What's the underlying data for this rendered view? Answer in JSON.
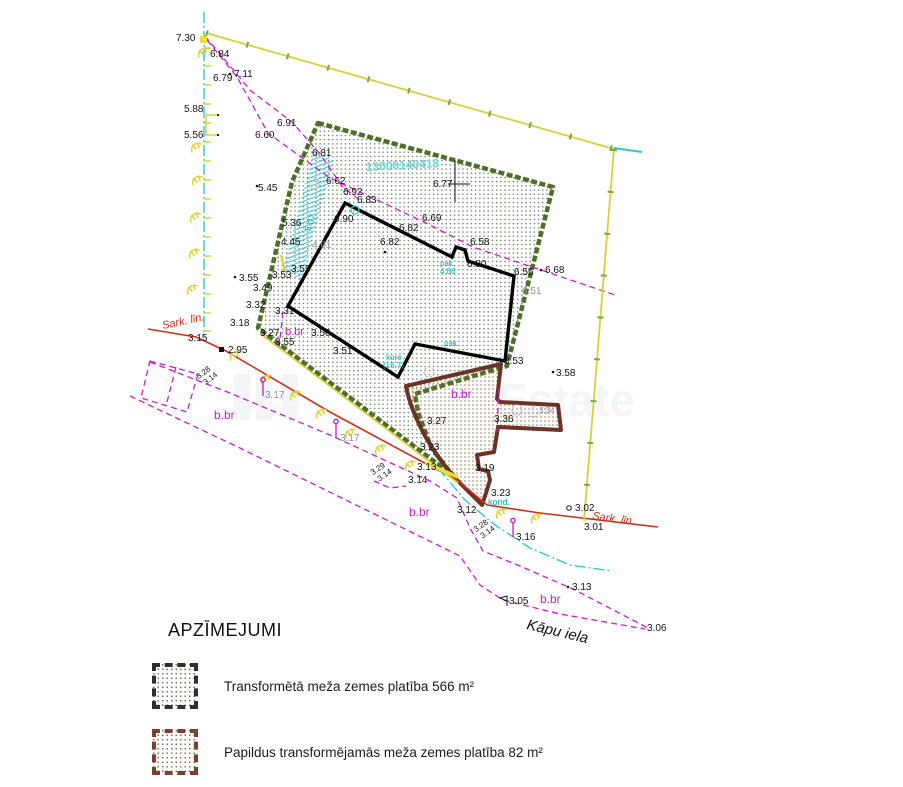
{
  "watermark": {
    "text": "Estate",
    "bars": [
      [
        234,
        374
      ],
      [
        256,
        374
      ],
      [
        282,
        374
      ]
    ],
    "text_x": 497,
    "text_y": 416
  },
  "legend": {
    "title": "APZĪMEJUMI",
    "items": [
      {
        "label": "Transformētā meža zemes platība 566 m²",
        "border": "#2f2f2f",
        "dot": "#6b7a5e"
      },
      {
        "label": "Papildus transformējamās meža zemes platība 82 m²",
        "border": "#7a4030",
        "dot": "#8a6f57"
      }
    ]
  },
  "colors": {
    "black": "#141414",
    "gray": "#8f8f8f",
    "magenta": "#c81dc8",
    "cyan": "#00b2b2",
    "cadastral": "#66d6d6",
    "red": "#d32a1a",
    "green_border": "#4f6e2a",
    "brown": "#6b3226",
    "yellow": "#d8d03a"
  },
  "plan": {
    "cadastral_number": "13000140418",
    "street": "Kāpu iela",
    "red_line_label": "Sark. līn.",
    "polygons": {
      "green": "318,123 553,187 507,366 480,374 415,394 418,412 431,447 446,467 456,478 258,328 292,182",
      "brown": "M406,386 L501,364 L497,399 L500,402 L558,405 L561,430 L498,427 L494,452 L477,455 L479,469 L488,471 L490,480 L486,493 L482,505 L456,479 Q432,452 419,424 Q409,403 406,386 Z",
      "building": "345,203 452,257 456,247 465,250 468,261 514,276 505,361 415,344 398,377 288,306",
      "hatch": "314,150 334,160 301,281 283,270",
      "roadRect": "150,361 198,374 187,412 141,398"
    },
    "polylines": [
      {
        "k": "md",
        "n": "plot-boundary-dashed-1",
        "p": "205,36 250,90 292,122 320,154 342,186 362,202"
      },
      {
        "k": "md",
        "n": "plot-boundary-dashed-2",
        "p": "207,40 237,77 268,133 330,178 424,222 473,247 618,296"
      },
      {
        "k": "md",
        "n": "road-band-upper",
        "p": "150,362 230,393 330,435 430,481 457,498 470,528 483,551 520,566 573,589 648,628"
      },
      {
        "k": "md",
        "n": "road-band-lower",
        "p": "130,396 240,448 350,502 460,556 480,585 503,600 560,614 645,629"
      },
      {
        "k": "md",
        "n": "dashed-tick-right",
        "p": "499,388 497,432"
      },
      {
        "k": "md",
        "n": "dashed-tick-left",
        "p": "283,312 279,348"
      },
      {
        "k": "md",
        "n": "dashed-curve-314",
        "p": "374,481 390,488 406,486"
      },
      {
        "k": "md",
        "n": "road-rect-divider",
        "p": "176,367 166,406"
      },
      {
        "k": "red",
        "n": "red-line",
        "p": "148,329 196,337 226,351 330,412 432,467 456,479 487,505 540,513 658,527"
      },
      {
        "k": "yel",
        "n": "fence-top",
        "p": "206,33 614,149"
      },
      {
        "k": "gtick",
        "n": "fence-top-ticks",
        "p": "206,33 614,149"
      },
      {
        "k": "yel",
        "n": "fence-right",
        "p": "614,149 584,521"
      },
      {
        "k": "gtick",
        "n": "fence-right-ticks",
        "p": "614,149 584,521"
      },
      {
        "k": "yel",
        "n": "fence-road",
        "p": "261,334 458,483"
      },
      {
        "k": "cdd",
        "n": "utility-line-left",
        "p": "204,12 204,336"
      },
      {
        "k": "cdd",
        "n": "utility-line-bottom",
        "p": "438,468 465,500 495,525 530,548 570,565 612,571"
      },
      {
        "k": "csolid",
        "n": "corner-tick",
        "p": "614,148 642,152"
      },
      {
        "k": "yel2",
        "n": "yellow-segment",
        "p": "281,255 285,272"
      },
      {
        "k": "yhl",
        "n": "yellow-highlight",
        "p": "425,463 458,477"
      }
    ],
    "labels": [
      {
        "t": "7.30",
        "x": 176,
        "y": 41
      },
      {
        "t": "6.84",
        "x": 210,
        "y": 57
      },
      {
        "t": "7.11",
        "x": 234,
        "y": 77
      },
      {
        "t": "6.79",
        "x": 213,
        "y": 81
      },
      {
        "t": "5.88",
        "x": 184,
        "y": 112
      },
      {
        "t": "5.56",
        "x": 184,
        "y": 138
      },
      {
        "t": "6.91",
        "x": 277,
        "y": 126
      },
      {
        "t": "6.60",
        "x": 255,
        "y": 138
      },
      {
        "t": "6.81",
        "x": 312,
        "y": 156
      },
      {
        "t": "6.62",
        "x": 326,
        "y": 184
      },
      {
        "t": "6.92",
        "x": 343,
        "y": 195
      },
      {
        "t": "6.83",
        "x": 357,
        "y": 203
      },
      {
        "t": "5.45",
        "x": 258,
        "y": 191
      },
      {
        "t": "6.77",
        "x": 433,
        "y": 187
      },
      {
        "t": "6.90",
        "x": 334,
        "y": 222
      },
      {
        "t": "6.69",
        "x": 422,
        "y": 221
      },
      {
        "t": "6.82",
        "x": 399,
        "y": 231
      },
      {
        "t": "6.82",
        "x": 380,
        "y": 245
      },
      {
        "t": "6.58",
        "x": 470,
        "y": 245
      },
      {
        "t": "5.36",
        "x": 282,
        "y": 226
      },
      {
        "t": "4.45",
        "x": 281,
        "y": 245
      },
      {
        "t": "4.61",
        "x": 312,
        "y": 248,
        "c": "g"
      },
      {
        "t": "6.80",
        "x": 467,
        "y": 267
      },
      {
        "t": "6.55",
        "x": 514,
        "y": 275
      },
      {
        "t": "6.68",
        "x": 545,
        "y": 273
      },
      {
        "t": "6.51",
        "x": 522,
        "y": 294,
        "c": "g"
      },
      {
        "t": "5.07",
        "x": 310,
        "y": 232,
        "c": "c",
        "s": 9,
        "r": -70
      },
      {
        "t": "3.55",
        "x": 291,
        "y": 272
      },
      {
        "t": "3.53",
        "x": 272,
        "y": 278
      },
      {
        "t": "3.49",
        "x": 253,
        "y": 291
      },
      {
        "t": "3.32",
        "x": 246,
        "y": 308
      },
      {
        "t": "3.31",
        "x": 275,
        "y": 314
      },
      {
        "t": "3.55",
        "x": 239,
        "y": 281
      },
      {
        "t": "3.27",
        "x": 260,
        "y": 336
      },
      {
        "t": "b.br",
        "x": 285,
        "y": 335,
        "c": "m",
        "s": 11
      },
      {
        "t": "3.55",
        "x": 275,
        "y": 345
      },
      {
        "t": "3.56",
        "x": 311,
        "y": 336
      },
      {
        "t": "3.51",
        "x": 333,
        "y": 354
      },
      {
        "t": "3.18",
        "x": 230,
        "y": 326
      },
      {
        "t": "3.15",
        "x": 188,
        "y": 341
      },
      {
        "t": "2.95",
        "x": 228,
        "y": 353
      },
      {
        "t": "Sark. līn.",
        "x": 163,
        "y": 329,
        "c": "r",
        "s": 11,
        "r": -12,
        "fs": "italic"
      },
      {
        "t": "3.17",
        "x": 265,
        "y": 398,
        "c": "g"
      },
      {
        "t": "3.17",
        "x": 340,
        "y": 441,
        "c": "g"
      },
      {
        "t": "b.br",
        "x": 214,
        "y": 419,
        "c": "m",
        "s": 12
      },
      {
        "t": "kore",
        "x": 386,
        "y": 360,
        "c": "c",
        "s": 8
      },
      {
        "t": "(16.7)",
        "x": 383,
        "y": 368,
        "c": "c",
        "s": 8
      },
      {
        "t": "pak.",
        "x": 440,
        "y": 266,
        "c": "c",
        "s": 8
      },
      {
        "t": "4.86",
        "x": 440,
        "y": 274,
        "c": "c",
        "s": 8
      },
      {
        "t": "pak.",
        "x": 444,
        "y": 346,
        "c": "c",
        "s": 8
      },
      {
        "t": "3.27",
        "x": 427,
        "y": 424
      },
      {
        "t": "3.23",
        "x": 420,
        "y": 450
      },
      {
        "t": "3.13",
        "x": 417,
        "y": 470
      },
      {
        "t": "3.14",
        "x": 408,
        "y": 483
      },
      {
        "t": "3.19",
        "x": 475,
        "y": 471
      },
      {
        "t": "3.36",
        "x": 494,
        "y": 422
      },
      {
        "t": "3.53",
        "x": 504,
        "y": 364
      },
      {
        "t": "3.58",
        "x": 556,
        "y": 376
      },
      {
        "t": "3.34",
        "x": 539,
        "y": 413,
        "c": "g",
        "s": 8
      },
      {
        "t": "b.br",
        "x": 451,
        "y": 398,
        "c": "m",
        "s": 12
      },
      {
        "t": "3.23",
        "x": 491,
        "y": 496
      },
      {
        "t": "kond.",
        "x": 488,
        "y": 505,
        "c": "c",
        "s": 9
      },
      {
        "t": "3.12",
        "x": 457,
        "y": 513
      },
      {
        "t": "b.br",
        "x": 409,
        "y": 516,
        "c": "m",
        "s": 12
      },
      {
        "t": "3.16",
        "x": 516,
        "y": 540
      },
      {
        "t": "3.02",
        "x": 575,
        "y": 511
      },
      {
        "t": "3.01",
        "x": 584,
        "y": 530
      },
      {
        "t": "Sark. līn.",
        "x": 592,
        "y": 519,
        "c": "r",
        "s": 11,
        "r": 8,
        "fs": "italic"
      },
      {
        "t": "3.13",
        "x": 572,
        "y": 590
      },
      {
        "t": "b.br",
        "x": 540,
        "y": 603,
        "c": "m",
        "s": 12
      },
      {
        "t": "3.05",
        "x": 509,
        "y": 604
      },
      {
        "t": "Kāpu iela",
        "x": 526,
        "y": 629,
        "s": 15,
        "r": 13,
        "fs": "italic"
      },
      {
        "t": "3.06",
        "x": 647,
        "y": 631
      },
      {
        "t": "13000140418",
        "x": 366,
        "y": 171,
        "c": "cc",
        "s": 12,
        "r": -3,
        "fw": 700
      }
    ],
    "fractions": [
      {
        "a": "3.28",
        "b": "3.14",
        "x": 200,
        "y": 381,
        "r": -38
      },
      {
        "a": "3.29",
        "b": "3.14",
        "x": 374,
        "y": 477,
        "r": -35
      },
      {
        "a": "3.28",
        "b": "3.14",
        "x": 477,
        "y": 534,
        "r": -35
      }
    ],
    "symbols": {
      "trees": [
        [
          205,
          55
        ],
        [
          198,
          150
        ],
        [
          199,
          183
        ],
        [
          197,
          220
        ],
        [
          196,
          256
        ],
        [
          194,
          292
        ],
        [
          237,
          358
        ],
        [
          268,
          382
        ],
        [
          297,
          398
        ],
        [
          323,
          416
        ],
        [
          352,
          436
        ],
        [
          382,
          452
        ],
        [
          412,
          468
        ],
        [
          503,
          516
        ],
        [
          538,
          521
        ]
      ],
      "signs": [
        [
          263,
          396
        ],
        [
          336,
          438
        ],
        [
          513,
          537
        ]
      ],
      "dots": [
        [
          230,
          74
        ],
        [
          257,
          186
        ],
        [
          235,
          277
        ],
        [
          541,
          270
        ],
        [
          553,
          372
        ],
        [
          385,
          252
        ],
        [
          568,
          587
        ]
      ],
      "boundary_square": [
        219,
        347
      ],
      "point_circle": [
        569,
        508
      ],
      "flag": [
        507,
        606
      ],
      "cross": {
        "v": [
          455,
          160,
          455,
          202
        ],
        "h": [
          448,
          184,
          470,
          184
        ]
      },
      "bracket": {
        "d": "M218,115 L206,115 L206,135 L218,135",
        "dots": [
          [
            218,
            115
          ],
          [
            218,
            135
          ]
        ]
      },
      "manhole_circle": [
        355,
        210
      ],
      "gray_trees": [
        [
          314,
          184
        ],
        [
          429,
          372
        ],
        [
          517,
          410
        ],
        [
          533,
          412
        ]
      ],
      "yellow_square": [
        200,
        36
      ],
      "ticks": {
        "x1": 204,
        "x2": 211,
        "ys": [
          48,
          66,
          85,
          104,
          123,
          142,
          161,
          180,
          199,
          218,
          237,
          256,
          275,
          294,
          313,
          331
        ]
      }
    }
  }
}
